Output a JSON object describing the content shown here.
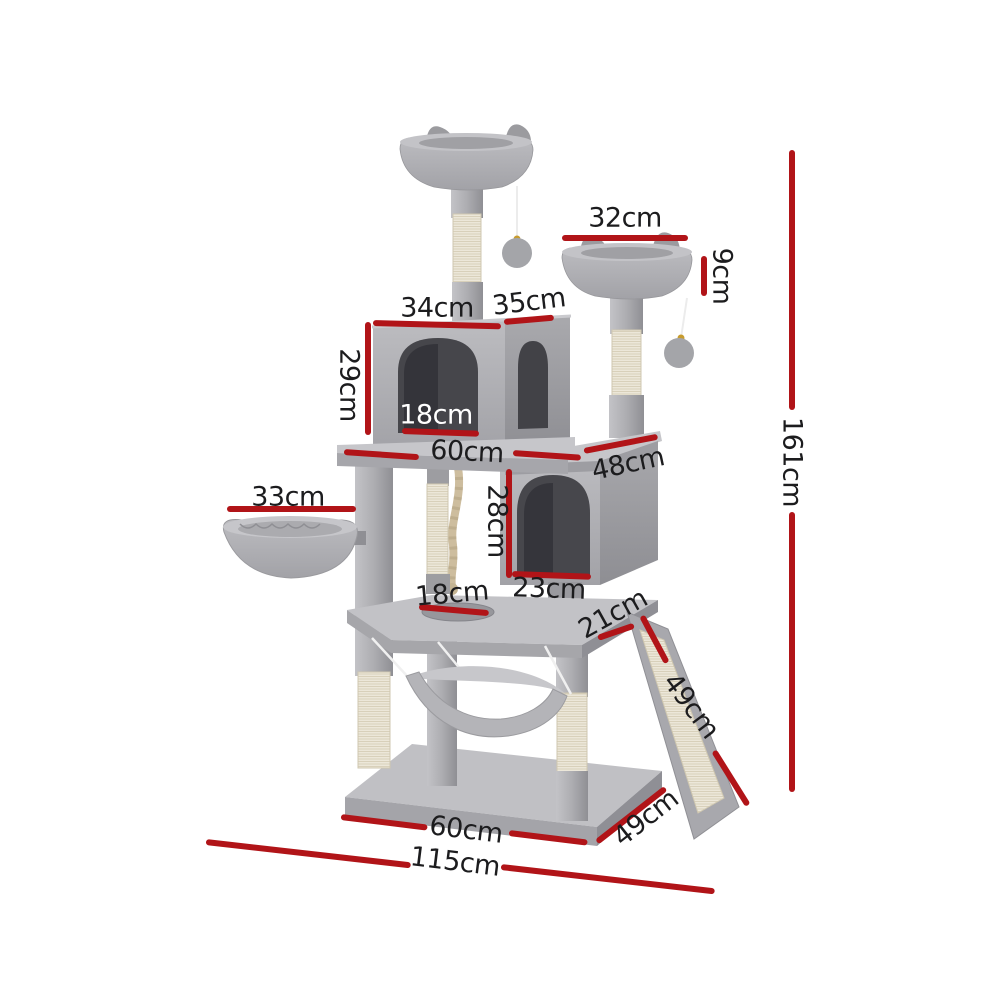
{
  "diagram": {
    "type": "product-dimensions",
    "subject": "Grey plush cat tree tower with scratching posts, two condos, two perches, basket, hammock and sisal ramp",
    "background_color": "#ffffff",
    "annotation_color": "#b11418",
    "label_color": "#1c1c1e",
    "label_color_inverse": "#ffffff",
    "labels": {
      "top_perch_width": "32cm",
      "top_perch_height": "9cm",
      "upper_condo_front_width": "34cm",
      "upper_condo_side_depth": "35cm",
      "upper_condo_height": "29cm",
      "upper_condo_door_width": "18cm",
      "middle_platform_width": "60cm",
      "middle_platform_side_depth": "48cm",
      "basket_width": "33cm",
      "lower_condo_height": "28cm",
      "lower_condo_door_width": "23cm",
      "lower_platform_hole_width": "18cm",
      "ramp_top_offset": "21cm",
      "ramp_length": "49cm",
      "total_height": "161cm",
      "base_front_width": "60cm",
      "base_side_depth": "49cm",
      "overall_width": "115cm"
    }
  }
}
